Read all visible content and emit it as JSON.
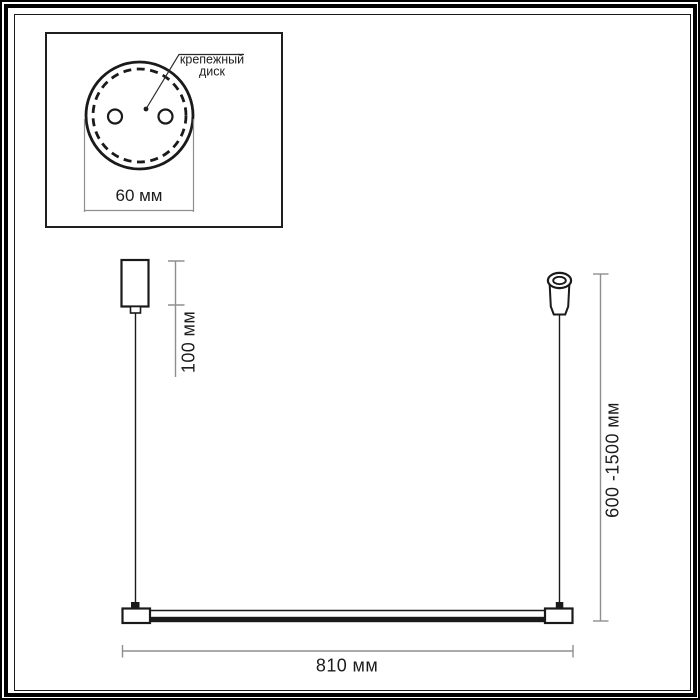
{
  "page": {
    "background": "#ffffff",
    "frame_color": "#000000"
  },
  "inset": {
    "callout": {
      "line1": "крепежный",
      "line2": "диск"
    },
    "diameter_label": "60 мм"
  },
  "drawing": {
    "line_color": "#1a1a1a",
    "dimension_line_color": "#8f8f8f",
    "labels": {
      "canopy_drop": "100 мм",
      "suspension_range": "600 -1500 мм",
      "bar_length": "810 мм"
    },
    "dimensions": [
      {
        "name": "mounting-disk-diameter",
        "label": "60 мм"
      },
      {
        "name": "canopy-drop",
        "label": "100 мм"
      },
      {
        "name": "suspension-height-range",
        "label": "600 -1500 мм"
      },
      {
        "name": "bar-length",
        "label": "810 мм"
      }
    ]
  }
}
